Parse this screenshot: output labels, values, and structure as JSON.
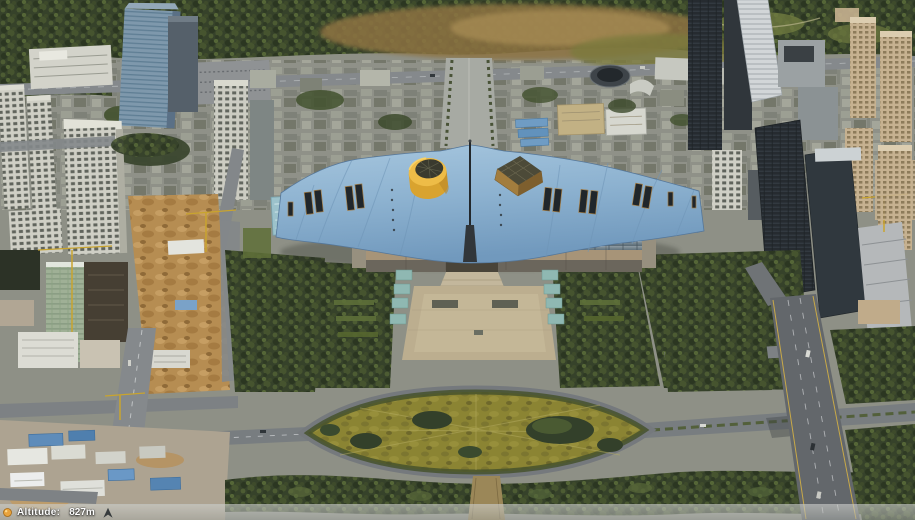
{
  "hud": {
    "altitude_label": "Altitude:",
    "altitude_value": "827m"
  },
  "icons": {
    "status_dot": "amber-dot-icon",
    "north_arrow": "north-arrow-icon"
  },
  "colors": {
    "hud_dot": "#e8a33d",
    "hud_dot_ring": "#a66a14",
    "hud_arrow": "#22272b",
    "hud_text": "#ffffff",
    "roof_blue": "#8db2d0",
    "roof_accent_yellow": "#eebc47",
    "roof_accent_brown": "#a27d3e",
    "lawn_olive": "#8b8433",
    "plaza_tan": "#bcae8f",
    "tree_green": "#36422a",
    "road_gray": "#7b8083",
    "dirt_tan": "#b68d52"
  }
}
